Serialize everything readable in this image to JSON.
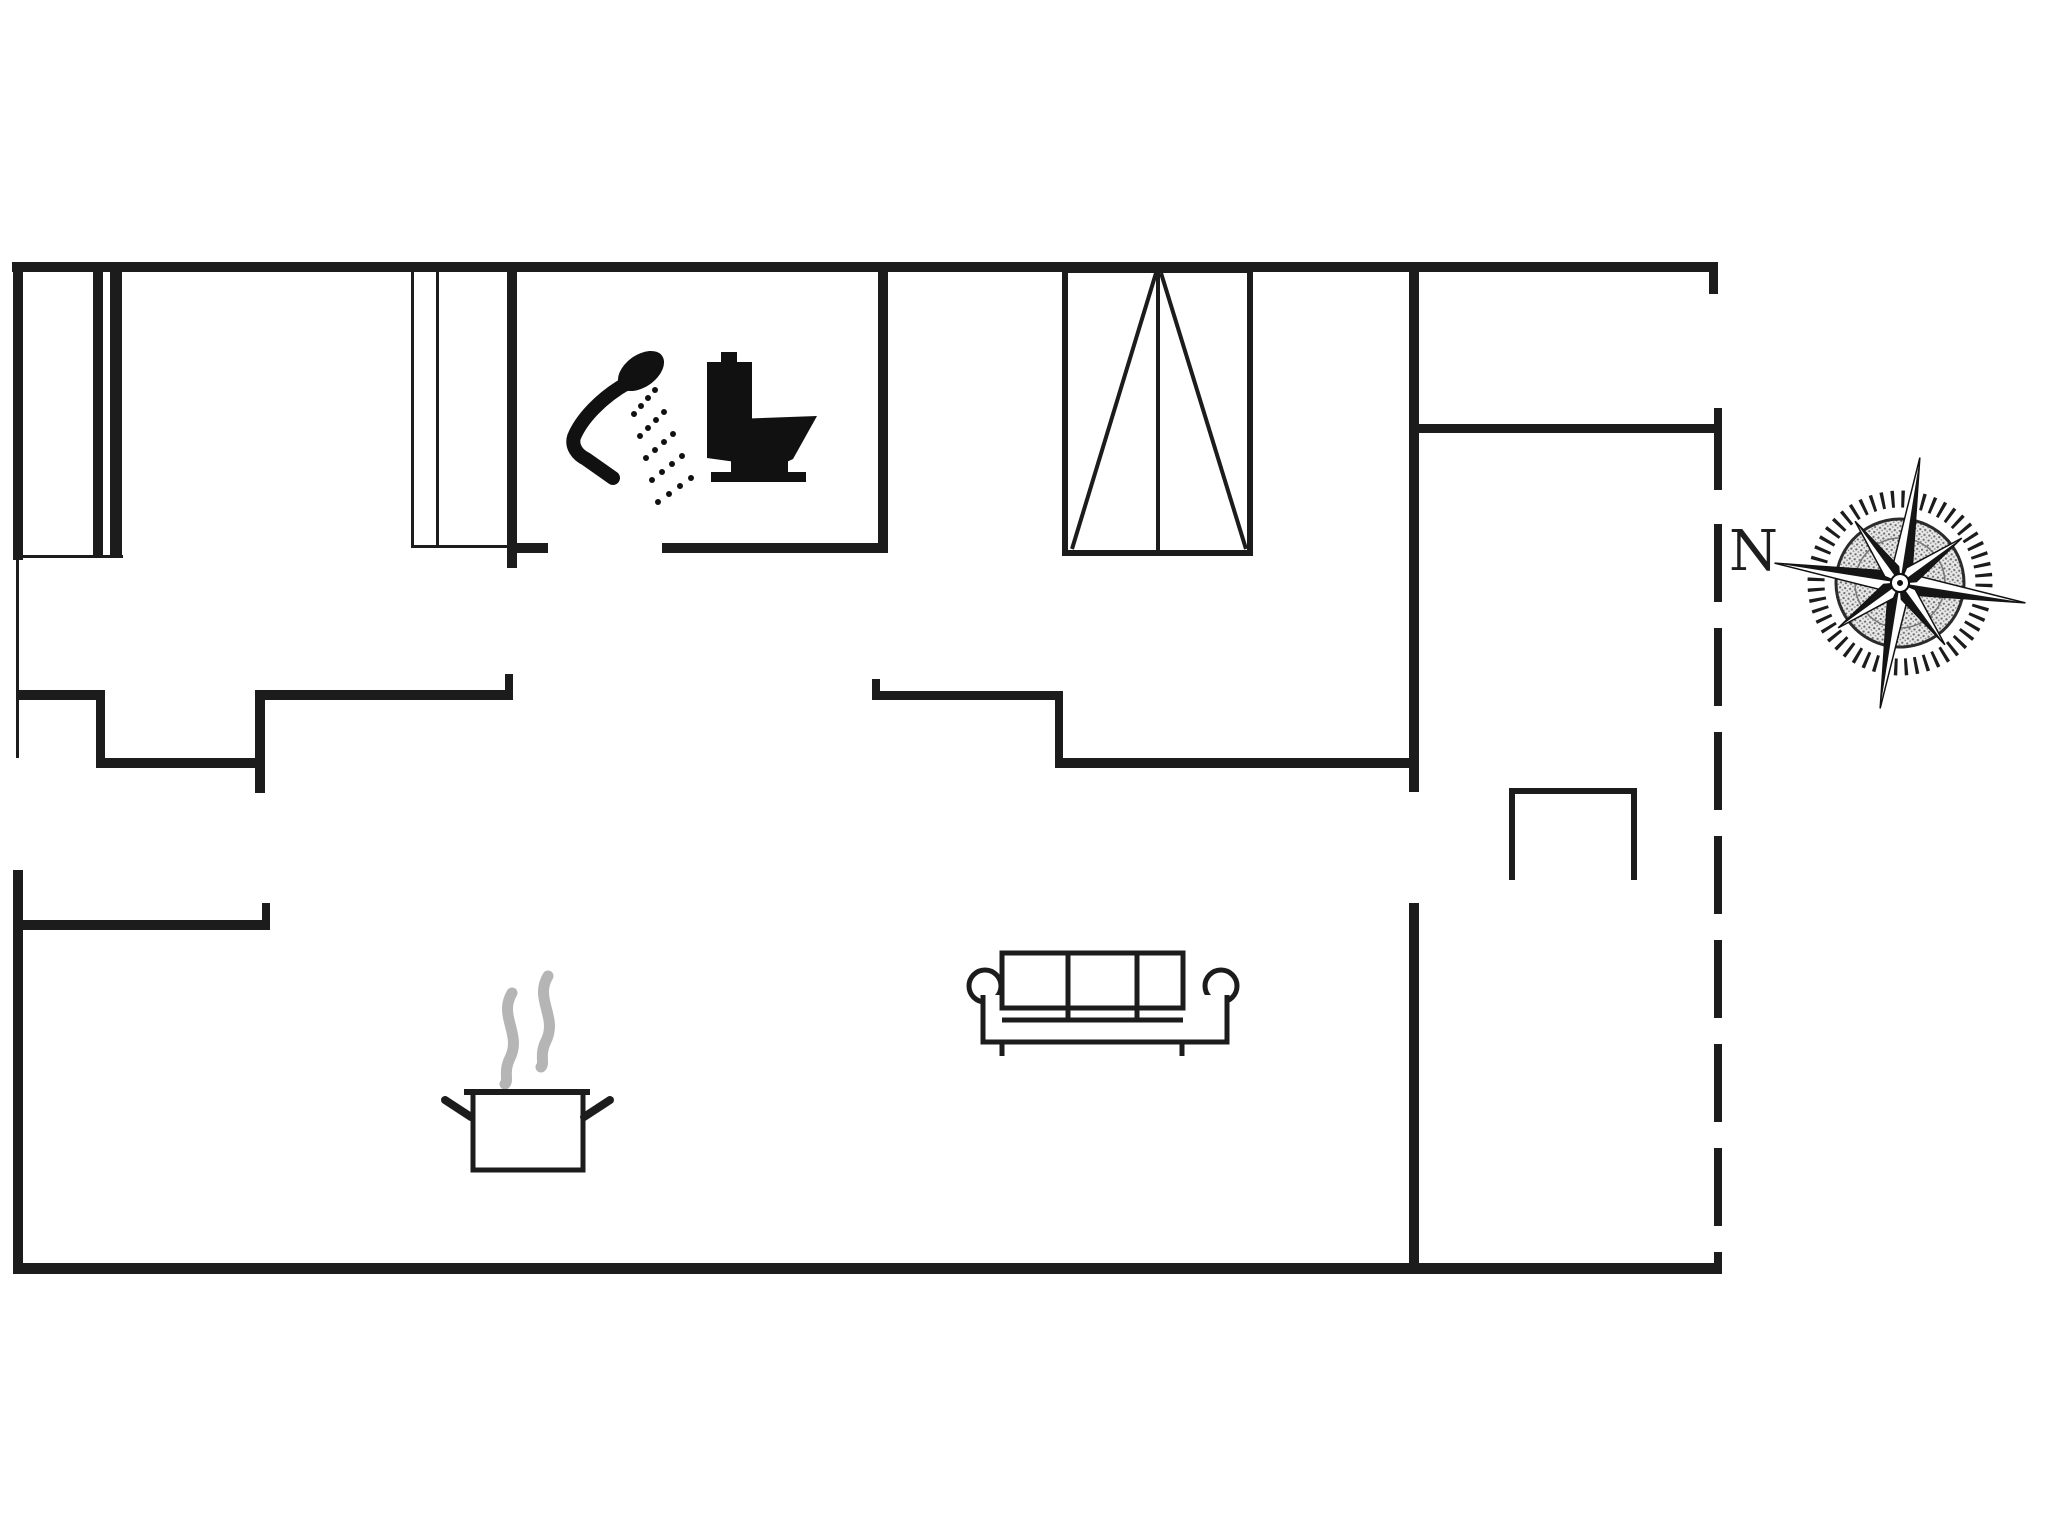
{
  "title": "Holiday house floor plan",
  "compass": {
    "label": "N"
  },
  "colors": {
    "background": "#ffffff",
    "wall": "#1c1c1c",
    "thin_line": "#2a2a2a",
    "steam": "#b5b5b5",
    "compass_stipple": "#6e6e6e"
  },
  "legend": {
    "dashed_line_meaning": "open / covered terrace boundary",
    "icons": [
      {
        "name": "shower-icon"
      },
      {
        "name": "toilet-icon"
      },
      {
        "name": "wardrobe-symbol"
      },
      {
        "name": "sofa-symbol"
      },
      {
        "name": "cooking-pot-icon"
      },
      {
        "name": "compass-rose-icon"
      }
    ]
  }
}
